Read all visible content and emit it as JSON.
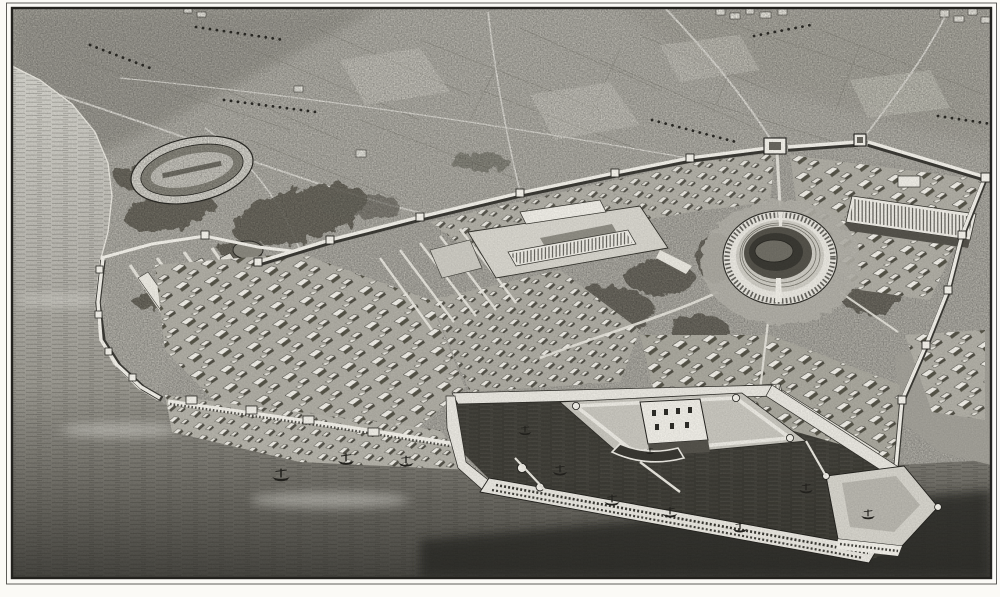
{
  "artwork": {
    "kind": "vintage-engraving",
    "subject": "Bird's-eye view of an ancient fortified port city",
    "style": "19th-century black-and-white line engraving",
    "perspective": "aerial oblique, sea at left and bottom, countryside rising to the top",
    "frame": "thin double rule plate border on white paper"
  },
  "palette": {
    "paper": "#fbfaf6",
    "ink": "#23221e",
    "land": "#b4b2aa",
    "land_far": "#a3a199",
    "city_base": "#b0aea5",
    "sea_dark_band": "#2a2925",
    "water_harbor": "#3a3933",
    "wall_white": "#f2f0e9",
    "building_light": "#efede6",
    "building_shadow": "#55534c",
    "vegetation": "#636157",
    "arena_floor": "#716f66",
    "terrace": "#b2b0a8",
    "platform": "#d8d6ce",
    "quay": "#e9e7e0"
  },
  "scene": {
    "setting": "walled classical city on a coastal plain, plowed fields and roads inland, open sea along the left and bottom edges",
    "landmarks": [
      {
        "name": "hippodrome-circus",
        "position": "upper left, oval racecourse amid trees"
      },
      {
        "name": "amphitheatre",
        "position": "right of center, round arcaded arena with dark bowl"
      },
      {
        "name": "forum-terrace",
        "position": "center, colonnaded rectangular precinct on the plateau"
      },
      {
        "name": "city-wall",
        "position": "long wall with square towers crossing the plateau and descending to the sea"
      },
      {
        "name": "gate-fortress",
        "position": "upper center-right, large square gate fort with flanking tower"
      },
      {
        "name": "warehouse-promontory",
        "position": "left, walled quarter with long storehouses and temples"
      },
      {
        "name": "harbor-basin",
        "position": "bottom center-right, rectangular port enclosed by quays"
      },
      {
        "name": "island-citadel",
        "position": "middle of the harbor, keep with corner towers and inner dock"
      },
      {
        "name": "arcaded-mole",
        "position": "bottom, long breakwater with two rows of arched openings"
      },
      {
        "name": "sea-bastion",
        "position": "bottom right, polygonal fort at the harbor mouth"
      },
      {
        "name": "boats",
        "position": "galleys and rowboats in the roadstead and basin"
      },
      {
        "name": "countryside",
        "position": "upper half, hedged fields, orchard rows, radiating roads, suburb clusters at the horizon"
      }
    ]
  }
}
